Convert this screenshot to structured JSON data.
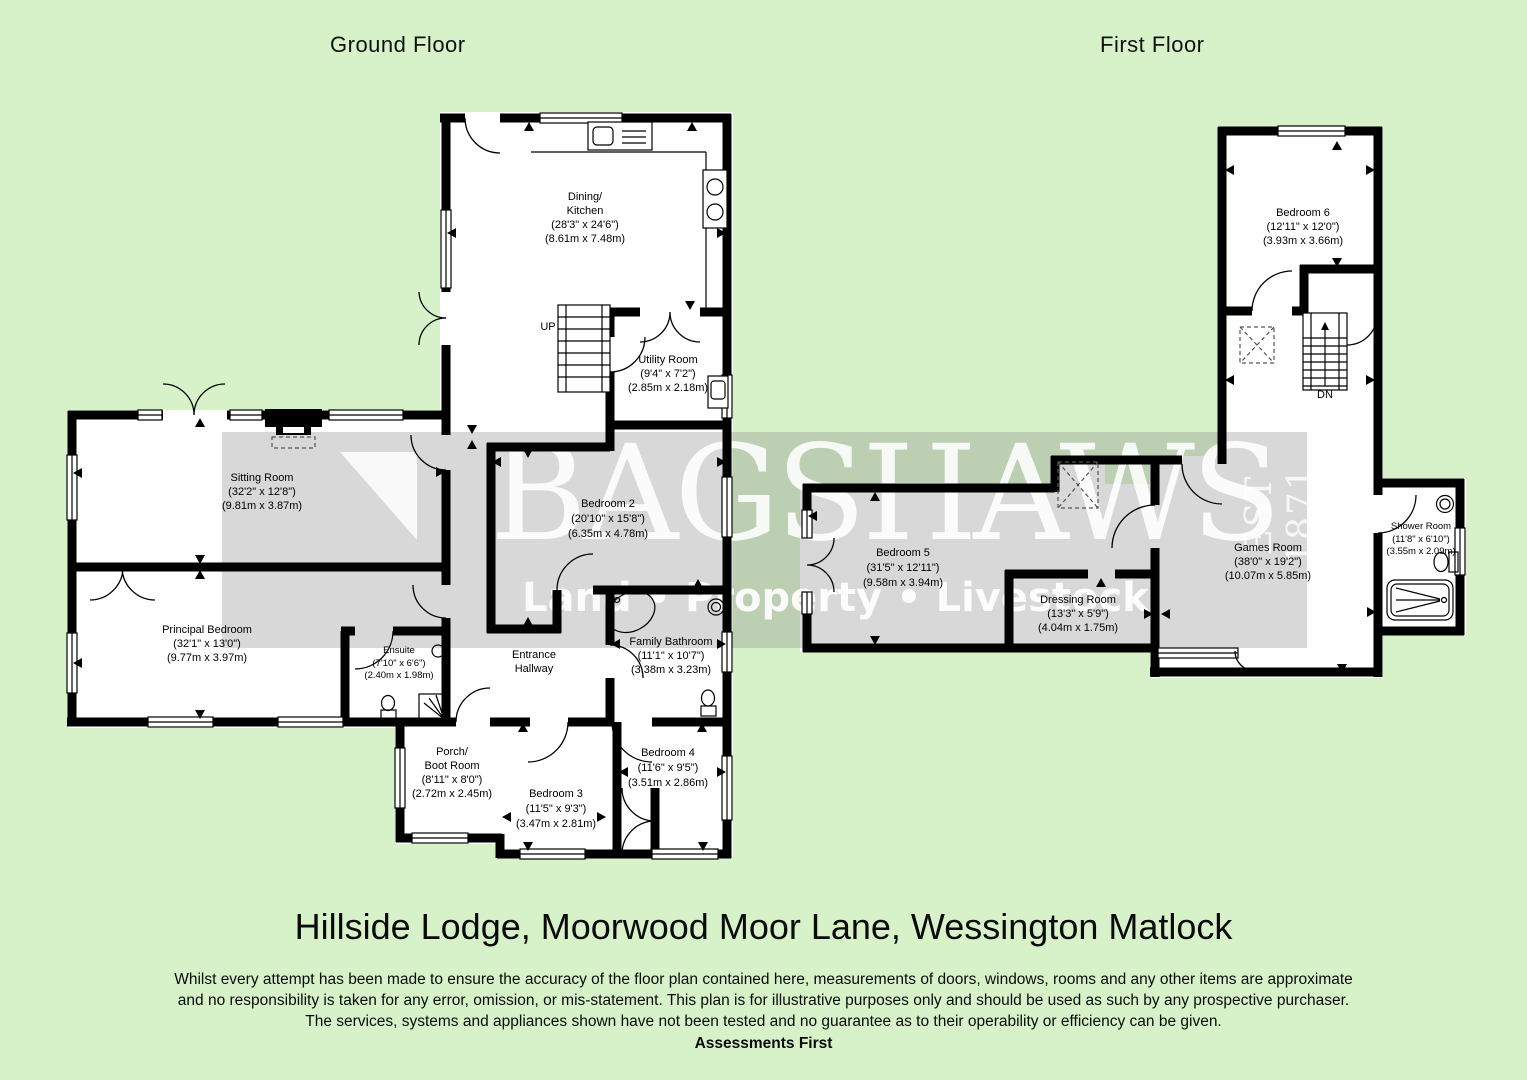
{
  "headers": {
    "ground_floor": "Ground Floor",
    "first_floor": "First Floor"
  },
  "watermark": {
    "name": "BAGSHAWS",
    "tagline": "Land • Property • Livestock",
    "est": "EST 1871"
  },
  "ground_floor": {
    "stairs_label": "UP",
    "rooms": {
      "dining_kitchen": {
        "name1": "Dining/",
        "name2": "Kitchen",
        "imperial": "(28'3\" x 24'6\")",
        "metric": "(8.61m x 7.48m)"
      },
      "utility": {
        "name": "Utility Room",
        "imperial": "(9'4\" x 7'2\")",
        "metric": "(2.85m x 2.18m)"
      },
      "sitting": {
        "name": "Sitting Room",
        "imperial": "(32'2\" x 12'8\")",
        "metric": "(9.81m x 3.87m)"
      },
      "principal": {
        "name": "Principal Bedroom",
        "imperial": "(32'1\" x 13'0\")",
        "metric": "(9.77m x 3.97m)"
      },
      "ensuite": {
        "name": "Ensuite",
        "imperial": "(7'10\" x 6'6\")",
        "metric": "(2.40m x 1.98m)"
      },
      "bedroom2": {
        "name": "Bedroom 2",
        "imperial": "(20'10\" x 15'8\")",
        "metric": "(6.35m x 4.78m)"
      },
      "hallway": {
        "name1": "Entrance",
        "name2": "Hallway"
      },
      "family_bathroom": {
        "name": "Family Bathroom",
        "imperial": "(11'1\" x 10'7\")",
        "metric": "(3.38m x 3.23m)"
      },
      "porch": {
        "name1": "Porch/",
        "name2": "Boot Room",
        "imperial": "(8'11\" x 8'0\")",
        "metric": "(2.72m x 2.45m)"
      },
      "bedroom3": {
        "name": "Bedroom 3",
        "imperial": "(11'5\" x 9'3\")",
        "metric": "(3.47m x 2.81m)"
      },
      "bedroom4": {
        "name": "Bedroom 4",
        "imperial": "(11'6\" x 9'5\")",
        "metric": "(3.51m x 2.86m)"
      }
    }
  },
  "first_floor": {
    "stairs_label": "DN",
    "rooms": {
      "bedroom6": {
        "name": "Bedroom 6",
        "imperial": "(12'11\" x 12'0\")",
        "metric": "(3.93m x 3.66m)"
      },
      "bedroom5": {
        "name": "Bedroom 5",
        "imperial": "(31'5\" x 12'11\")",
        "metric": "(9.58m x 3.94m)"
      },
      "dressing": {
        "name": "Dressing Room",
        "imperial": "(13'3\" x 5'9\")",
        "metric": "(4.04m x 1.75m)"
      },
      "games": {
        "name": "Games Room",
        "imperial": "(38'0\" x 19'2\")",
        "metric": "(10.07m x 5.85m)"
      },
      "shower": {
        "name": "Shower Room",
        "imperial": "(11'8\" x 6'10\")",
        "metric": "(3.55m x 2.09m)"
      }
    }
  },
  "footer": {
    "title": "Hillside Lodge, Moorwood Moor Lane, Wessington Matlock",
    "disclaimer1": "Whilst every attempt has been made to ensure the accuracy of the floor plan contained here, measurements of doors, windows, rooms and any other items are approximate",
    "disclaimer2": "and no responsibility is taken for any error, omission, or mis-statement. This plan is for illustrative purposes only and should be used as such by any prospective purchaser.",
    "disclaimer3": "The services, systems and appliances shown have not been tested and no guarantee as to their operability or efficiency can be given.",
    "brand": "Assessments First"
  }
}
